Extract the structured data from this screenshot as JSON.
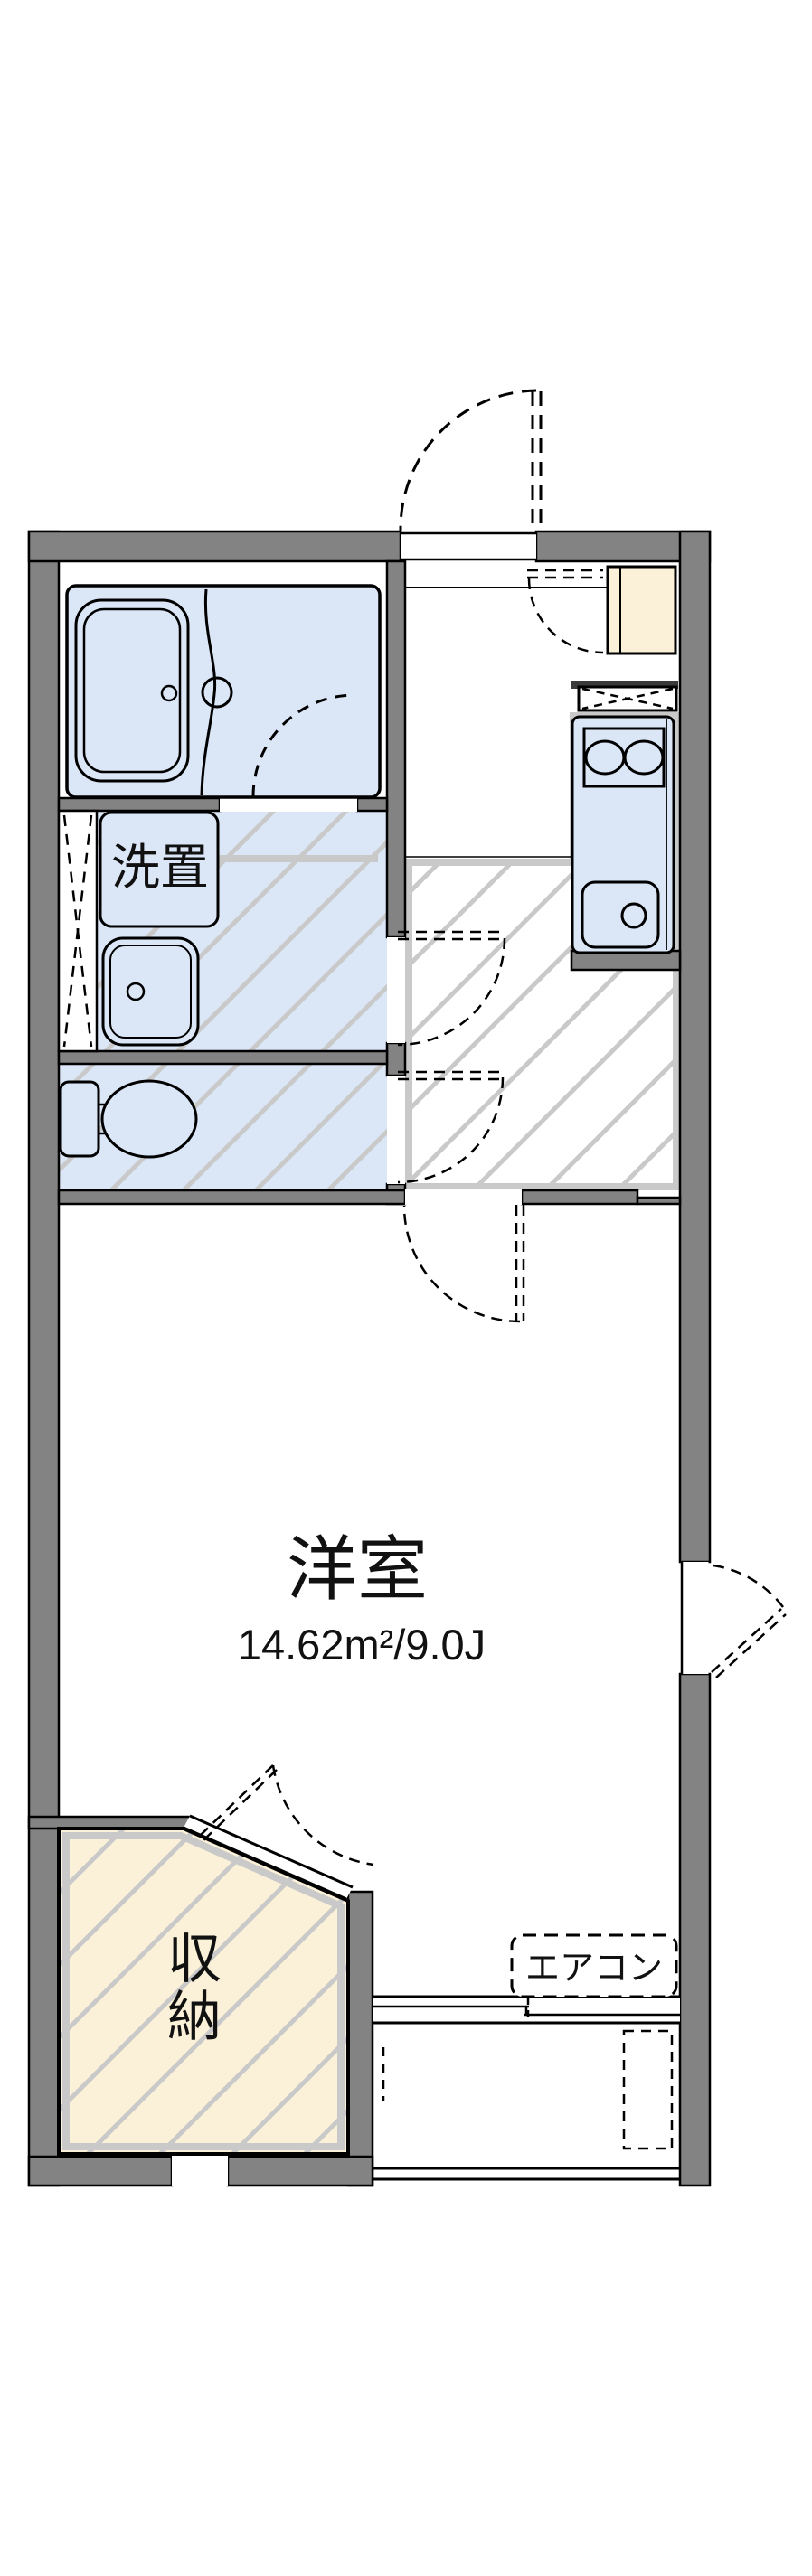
{
  "floor_plan": {
    "labels": {
      "washer_space": "洗置",
      "main_room": "洋室",
      "main_room_area": "14.62m²/9.0J",
      "storage_char_1": "収",
      "storage_char_2": "納",
      "air_conditioner": "エアコン"
    },
    "colors": {
      "wall_gray": "#838383",
      "fixture_blue": "#dbe7f7",
      "cabinet_cream": "#fbf1d8",
      "hatch_silver": "#c9c9c9",
      "line_black": "#000000"
    }
  }
}
